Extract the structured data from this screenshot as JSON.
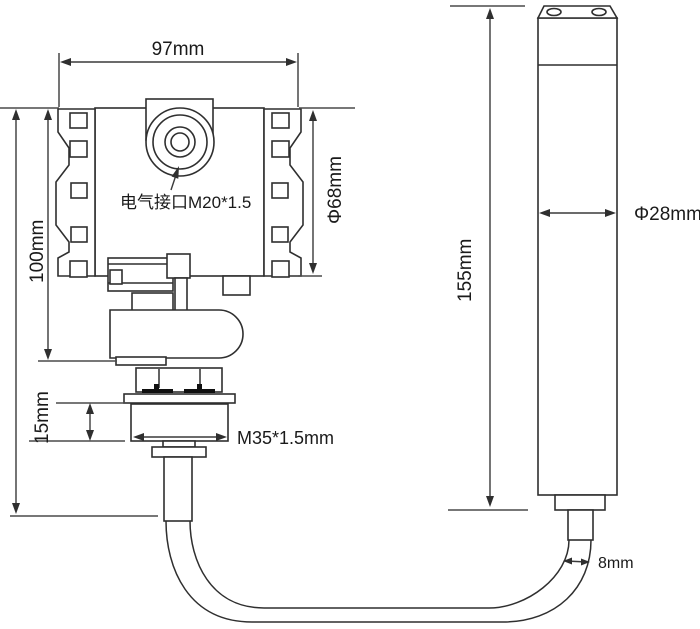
{
  "labels": {
    "head_width": "97mm",
    "head_height": "100mm",
    "head_diameter": "Φ68mm",
    "electrical_interface": "电气接口M20*1.5",
    "thread_height": "15mm",
    "thread_spec": "M35*1.5mm",
    "probe_length": "155mm",
    "probe_diameter": "Φ28mm",
    "cable_diameter": "8mm"
  },
  "colors": {
    "line": "#2f2f2f",
    "dimension": "#3a3a3a",
    "background": "#ffffff",
    "seal": "#101010"
  }
}
